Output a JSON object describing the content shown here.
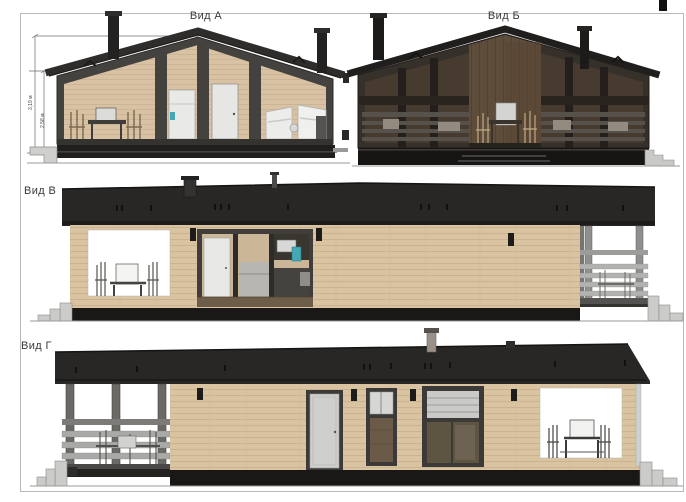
{
  "document": {
    "type": "architectural-elevation-sheet",
    "background": "#ffffff",
    "frame_color": "#b9b9b9"
  },
  "views": {
    "a": {
      "label": "Вид А"
    },
    "b": {
      "label": "Вид Б"
    },
    "v": {
      "label": "Вид В"
    },
    "g": {
      "label": "Вид Г"
    }
  },
  "dimensions": {
    "total_height": "3,19 м",
    "wall_height": "2,58 м"
  },
  "palette": {
    "roof_dark": "#282725",
    "frame_dark": "#3c3a38",
    "wood_siding": "#d9c3a1",
    "interior_tan": "#d8c2a3",
    "dark_base": "#191817",
    "railing_gray": "#a9a9a7",
    "steps_gray": "#cbcbc9",
    "dark_body_b": "#36302a",
    "center_panel_brown": "#5f4d3b",
    "accent_teal": "#45a8b5",
    "white_opening": "#ffffff"
  }
}
